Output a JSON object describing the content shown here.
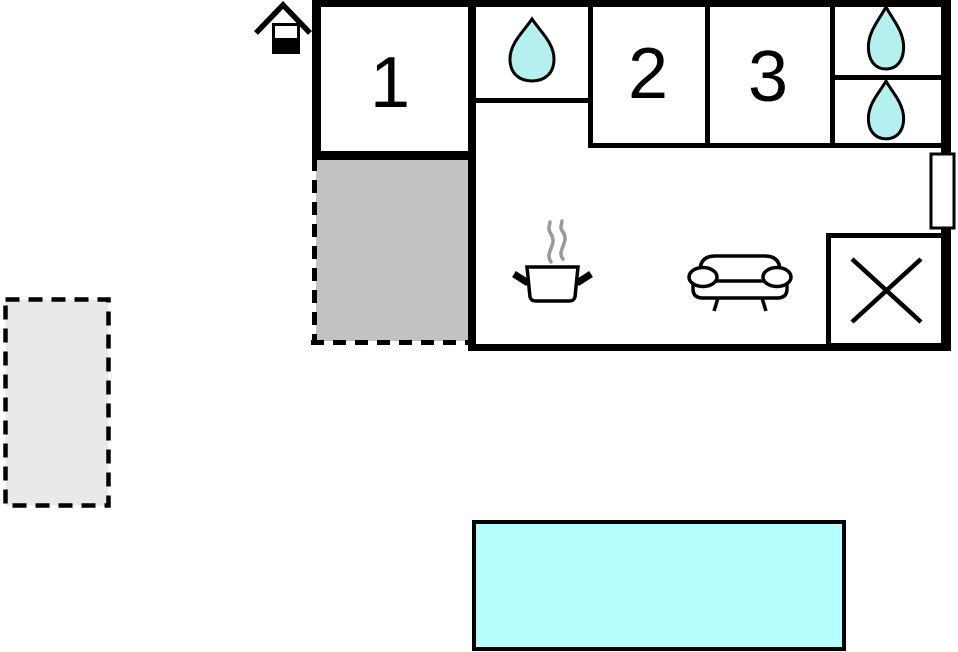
{
  "colors": {
    "wall": "#000000",
    "text": "#000000",
    "drop_fill": "#b4f0f0",
    "pool_fill": "#b6ffff",
    "terrace_fill": "#c2c2c2",
    "patio_fill": "#e9e9e9",
    "steam": "#999999",
    "room_fill": "#ffffff"
  },
  "rooms": {
    "bedroom1": {
      "label": "1",
      "icon": ""
    },
    "bedroom2": {
      "label": "2",
      "icon": ""
    },
    "bedroom3": {
      "label": "3",
      "icon": ""
    },
    "bathroom1": {
      "icon": "water-drop-icon"
    },
    "bathroom2": {
      "icon": "water-drop-icon"
    },
    "bathroom3": {
      "icon": "water-drop-icon"
    },
    "kitchen": {
      "icon": "cooking-pot-icon"
    },
    "living_room": {
      "icon": "sofa-icon"
    },
    "annex": {
      "icon": "x-mark-icon"
    }
  },
  "outdoor": {
    "terrace": {
      "border": "dashed"
    },
    "patio": {
      "border": "dashed"
    },
    "pool": {
      "border": "solid"
    }
  },
  "entrance": {
    "icon": "house-entrance-icon"
  }
}
